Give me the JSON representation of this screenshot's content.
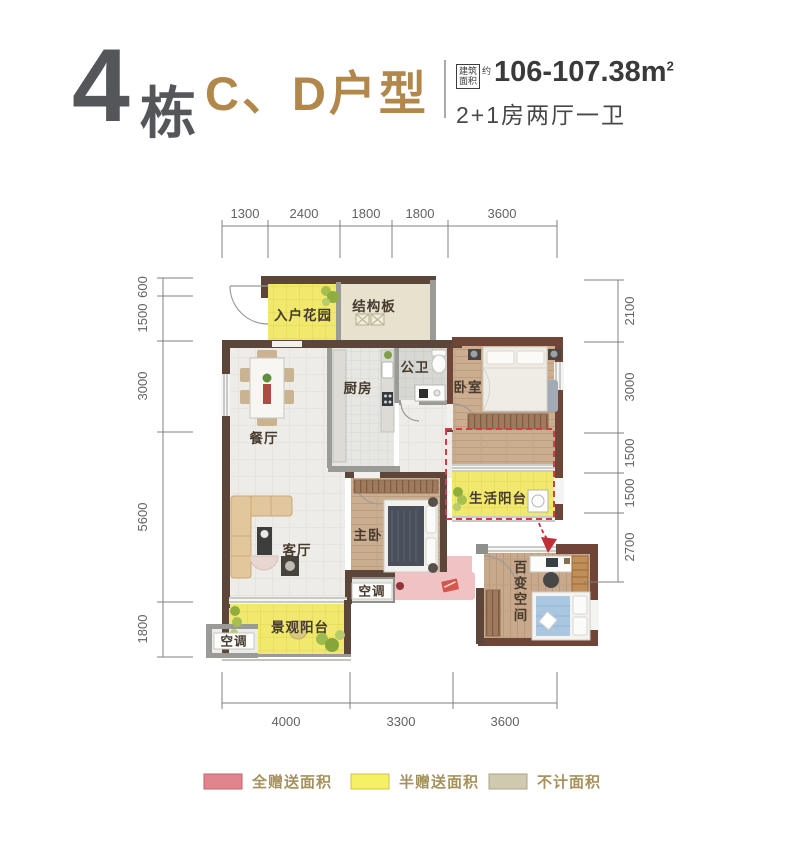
{
  "header": {
    "building_num": "4",
    "building_suffix": "栋",
    "unit_name": "C、D户型",
    "area_tag_top": "建筑",
    "area_tag_bottom": "面积",
    "area_tag_approx": "约",
    "area_value": "106-107.38m",
    "area_exponent": "2",
    "room_config": "2+1房两厅一卫"
  },
  "dimensions": {
    "top": [
      "1300",
      "2400",
      "1800",
      "1800",
      "3600"
    ],
    "left": [
      "600",
      "1500",
      "3000",
      "5600",
      "1800"
    ],
    "right": [
      "2100",
      "3000",
      "1500",
      "1500",
      "2700"
    ],
    "bottom": [
      "4000",
      "3300",
      "3600"
    ]
  },
  "rooms": {
    "entry_garden": "入户花园",
    "structure_slab": "结构板",
    "public_bath": "公卫",
    "kitchen": "厨房",
    "bedroom": "卧室",
    "dining": "餐厅",
    "service_balcony": "生活阳台",
    "master_bedroom": "主卧",
    "living": "客厅",
    "ac_platform_1": "空调",
    "flex_space": "百变空间",
    "view_balcony": "景观阳台",
    "ac_platform_2": "空调"
  },
  "legend": [
    {
      "label": "全赠送面积",
      "color": "#e1848d"
    },
    {
      "label": "半赠送面积",
      "color": "#f6f164"
    },
    {
      "label": "不计面积",
      "color": "#cfc9ae"
    }
  ],
  "colors": {
    "accent_gold": "#b1874b",
    "dash_red": "#d23b47",
    "wall_brown": "#5b4639",
    "wall_redbrown": "#6e4536"
  }
}
